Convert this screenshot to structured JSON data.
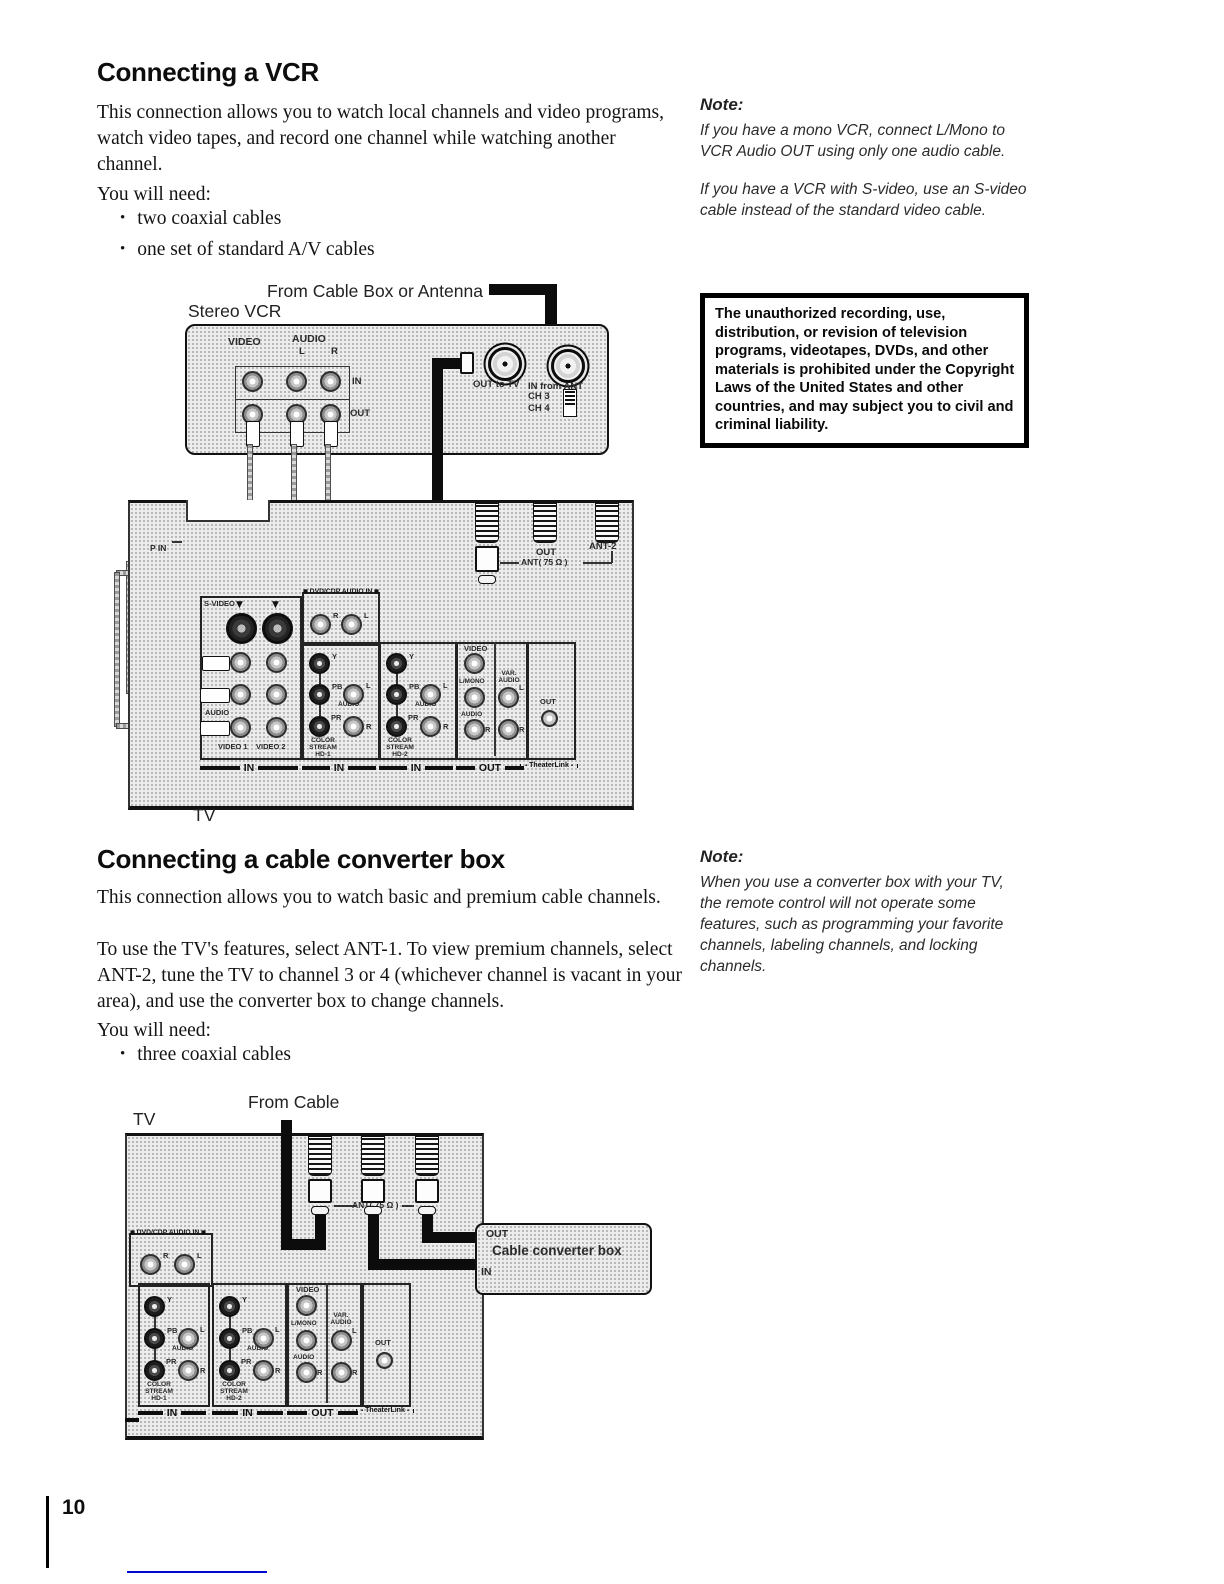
{
  "page": {
    "number": "10"
  },
  "vcr_section": {
    "title": "Connecting a VCR",
    "intro": "This connection allows you to watch local channels and video programs, watch video tapes, and record one channel while watching another channel.",
    "need_label": "You will need:",
    "bullets": [
      "two coaxial cables",
      "one set of standard A/V cables"
    ],
    "note_title": "Note:",
    "note_para1": "If you have a mono VCR, connect L/Mono to VCR Audio OUT using only one audio cable.",
    "note_para2": "If you have a VCR with S-video, use an S-video cable instead of the standard video cable.",
    "warning": "The unauthorized recording, use, distribution, or revision of television programs, videotapes, DVDs, and other materials is prohibited under the Copyright Laws of the United States and other countries, and may subject you to civil and criminal liability."
  },
  "converter_section": {
    "title": "Connecting a cable converter box",
    "intro": "This connection allows you to watch basic and premium cable channels.",
    "para2": "To use the TV's features, select ANT-1. To view premium channels, select ANT-2, tune the TV to channel 3 or 4 (whichever channel is vacant in your area), and use the converter box to change channels.",
    "need_label": "You will need:",
    "bullets": [
      "three coaxial cables"
    ],
    "note_title": "Note:",
    "note_para1": "When you use a converter box with your TV, the remote control will not operate some features, such as programming your favorite channels, labeling channels, and locking channels."
  },
  "diagram1": {
    "source_label": "From Cable Box or Antenna",
    "vcr_label": "Stereo VCR",
    "tv_label": "TV",
    "vcr_video": "VIDEO",
    "vcr_audio": "AUDIO",
    "vcr_l": "L",
    "vcr_r": "R",
    "vcr_in": "IN",
    "vcr_out": "OUT",
    "rf_out_label": "OUT  to TV",
    "rf_in_label": "IN from ANT",
    "ch3": "CH 3",
    "ch4": "CH 4",
    "p_in": "P IN",
    "ant_out": "OUT",
    "ant2": "ANT-2",
    "ant75": "ANT( 75 Ω )"
  },
  "diagram2": {
    "source_label": "From Cable",
    "tv_label": "TV",
    "box_out": "OUT",
    "box_name": "Cable converter box",
    "box_in": "IN",
    "ant75": "ANT( 75 Ω )"
  },
  "panel": {
    "s_video": "S-VIDEO",
    "dvd_audio_in": "DVD/CDP AUDIO IN",
    "r": "R",
    "l": "L",
    "y": "Y",
    "pb": "PB",
    "pr": "PR",
    "audio": "AUDIO",
    "video": "VIDEO",
    "l_mono": "L/MONO",
    "var_audio": "VAR. AUDIO",
    "cs_hd1": "COLOR STREAM HD-1",
    "cs_hd2": "COLOR STREAM HD-2",
    "in": "IN",
    "out": "OUT",
    "theaterlink": "TheaterLink",
    "video1": "VIDEO 1",
    "video2": "VIDEO 2",
    "down_arrow": "▼"
  }
}
